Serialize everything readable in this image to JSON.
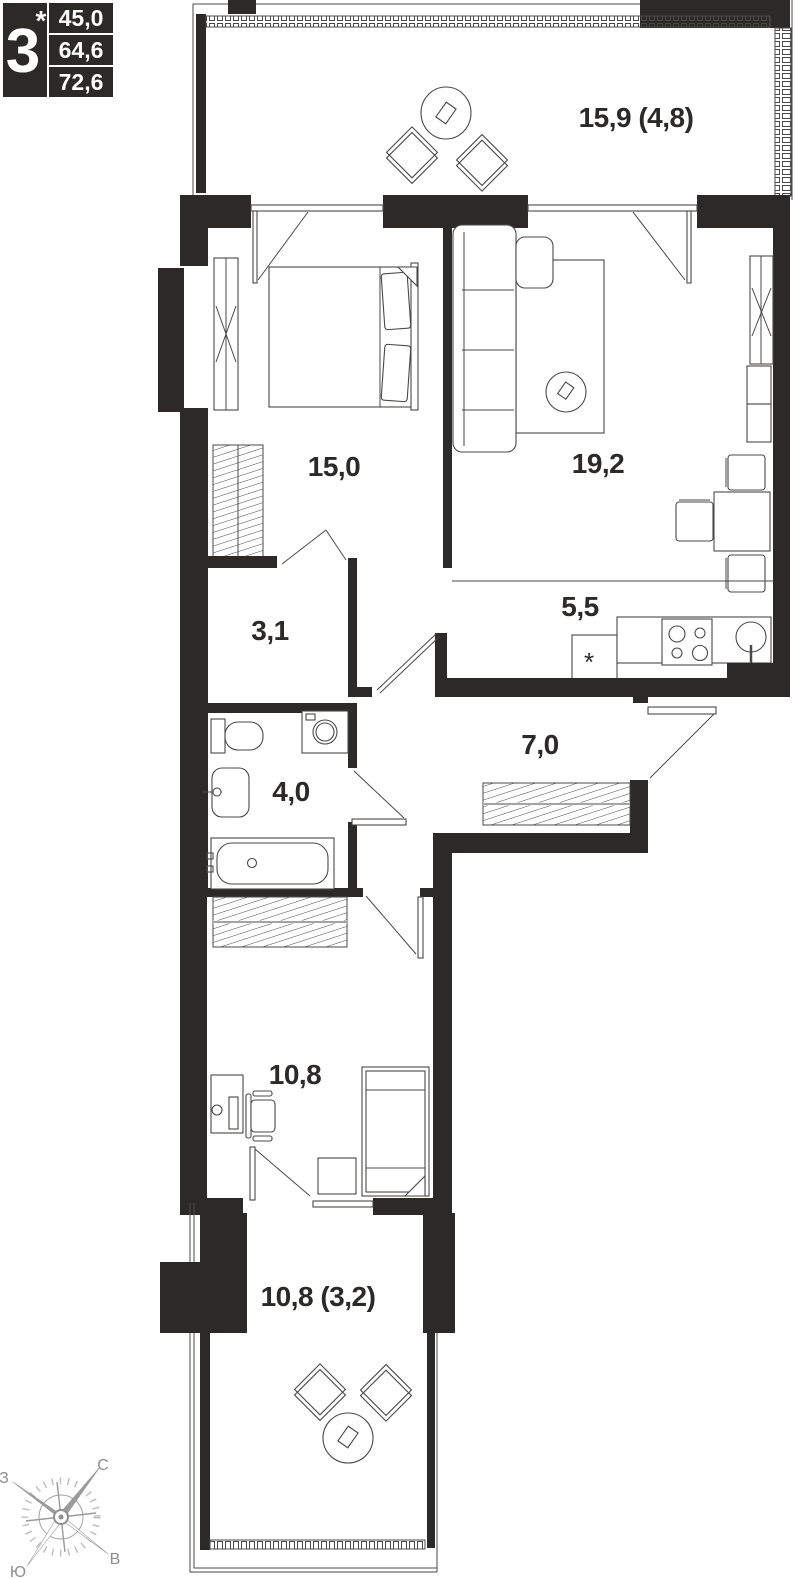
{
  "apartment_card": {
    "rooms_count": "3",
    "star": "*",
    "areas": {
      "living": "45,0",
      "total": "64,6",
      "total_with_summer": "72,6"
    }
  },
  "plan": {
    "rooms": [
      {
        "id": "balcony-top",
        "label": "15,9 (4,8)"
      },
      {
        "id": "bedroom",
        "label": "15,0"
      },
      {
        "id": "living-room",
        "label": "19,2"
      },
      {
        "id": "storage",
        "label": "3,1"
      },
      {
        "id": "kitchen",
        "label": "5,5"
      },
      {
        "id": "bathroom",
        "label": "4,0"
      },
      {
        "id": "hallway",
        "label": "7,0"
      },
      {
        "id": "bedroom-2",
        "label": "10,8"
      },
      {
        "id": "balcony-bottom",
        "label": "10,8 (3,2)"
      }
    ],
    "fridge_mark": "*"
  },
  "compass": {
    "north": "С",
    "south": "Ю",
    "west": "З",
    "east": "В"
  },
  "colors": {
    "wall": "#2B2A29",
    "line": "#4a4948",
    "background": "#ffffff"
  }
}
